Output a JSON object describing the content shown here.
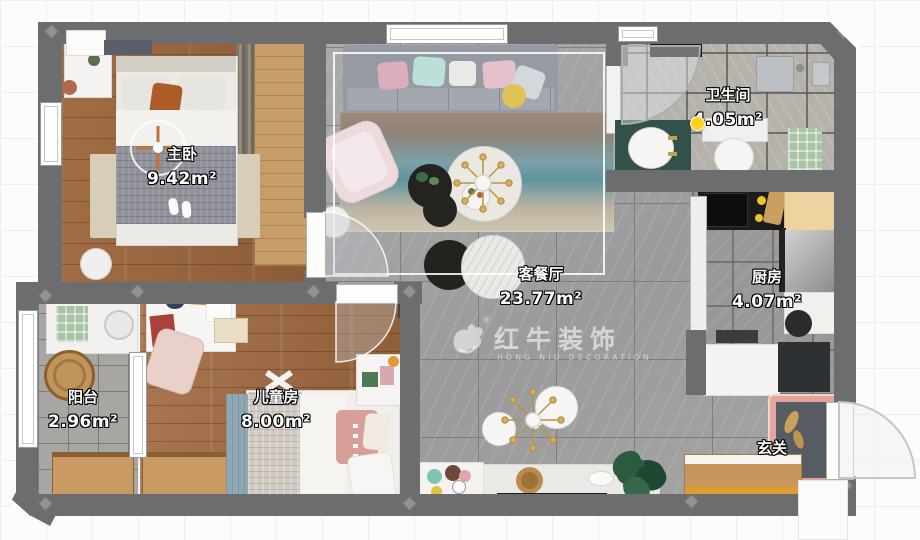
{
  "rooms": {
    "master": {
      "name": "主卧",
      "area": "9.42m²"
    },
    "bathroom": {
      "name": "卫生间",
      "area": "4.05m²"
    },
    "living": {
      "name": "客餐厅",
      "area": "23.77m²"
    },
    "kitchen": {
      "name": "厨房",
      "area": "4.07m²"
    },
    "balcony": {
      "name": "阳台",
      "area": "2.96m²"
    },
    "kids": {
      "name": "儿童房",
      "area": "8.00m²"
    },
    "entry": {
      "name": "玄关"
    }
  },
  "watermark": {
    "brand": "红牛装饰",
    "subtitle": "HONG NIU DECORATION",
    "registered": "®"
  },
  "marker": {
    "color": "#ffd21c"
  }
}
